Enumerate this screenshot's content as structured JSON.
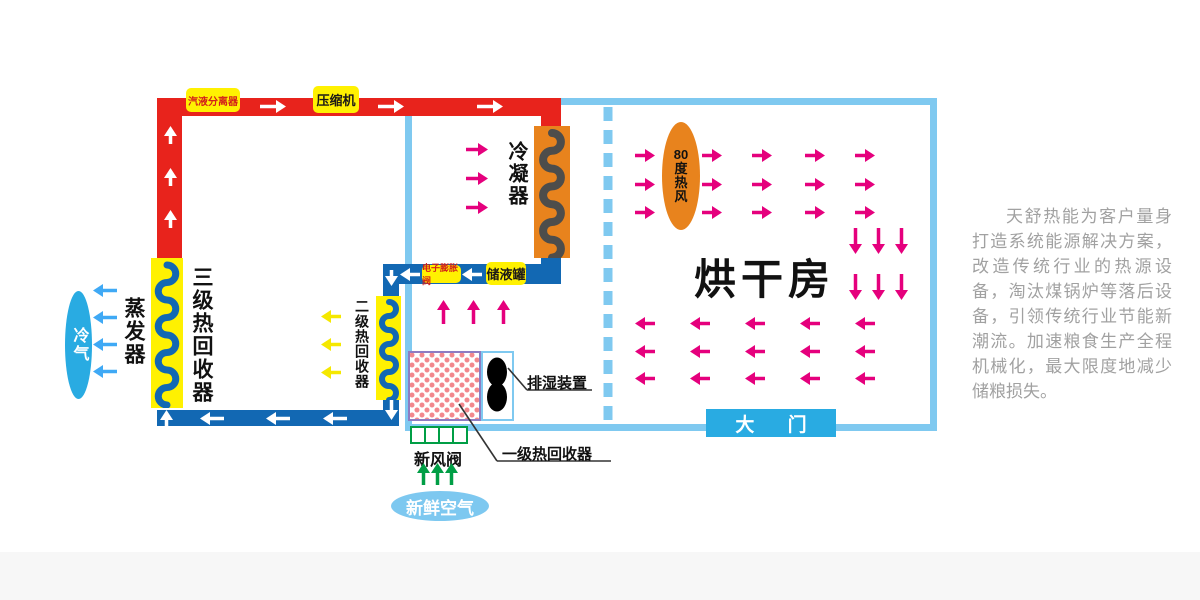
{
  "labels": {
    "gas_liquid_separator": "汽液分离器",
    "compressor": "压缩机",
    "condenser": "冷凝器",
    "expansion_valve": "电子膨胀阀",
    "liquid_tank": "储液罐",
    "stage3_recovery": "三级热回收器",
    "stage2_recovery": "二级热回收器",
    "stage1_recovery": "一级热回收器",
    "evaporator": "蒸发器",
    "cold_air": "冷气",
    "dehumidifier": "排湿装置",
    "fresh_air_valve": "新风阀",
    "fresh_air": "新鲜空气",
    "hot_air_80": "80度热风",
    "drying_room": "烘干房",
    "door": "大 门"
  },
  "description": "天舒热能为客户量身打造系统能源解决方案，改造传统行业的热源设备，淘汰煤锅炉等落后设备，引领传统行业节能新潮流。加速粮食生产全程机械化，最大限度地减少储粮损失。",
  "colors": {
    "pipe_hot": "#e8231c",
    "pipe_cold": "#1268b3",
    "wall": "#7fc9f0",
    "label_bg": "#fff101",
    "condenser": "#e8831d",
    "coil_dark": "#4d4d4b",
    "flow_pink": "#e5007d",
    "flow_blue": "#3fa9f5",
    "flow_green": "#009e45",
    "flow_yellow": "#f5e800",
    "oval_blue": "#29abe2",
    "oval_light": "#7dc8f0",
    "text_gray": "#a1a1a1",
    "door": "#29abe2"
  },
  "flows": [
    {
      "name": "refrigerant-up-arrows",
      "dir": "up",
      "len": 18,
      "color": "#ffffff",
      "points": [
        [
          164,
          126
        ],
        [
          164,
          168
        ],
        [
          164,
          210
        ]
      ]
    },
    {
      "name": "refrigerant-right-arrows",
      "dir": "right",
      "len": 26,
      "color": "#ffffff",
      "points": [
        [
          260,
          100
        ],
        [
          378,
          100
        ],
        [
          477,
          100
        ]
      ]
    },
    {
      "name": "condenser-heat-arrows",
      "dir": "right",
      "len": 22,
      "color": "#e5007d",
      "points": [
        [
          466,
          143
        ],
        [
          466,
          172
        ],
        [
          466,
          201
        ]
      ]
    },
    {
      "name": "liquid-line-left-arrows",
      "dir": "left",
      "len": 20,
      "color": "#ffffff",
      "points": [
        [
          400,
          268
        ],
        [
          462,
          268
        ]
      ]
    },
    {
      "name": "stage2-down-arrow",
      "dir": "down",
      "len": 20,
      "color": "#ffffff",
      "points": [
        [
          385,
          400
        ]
      ]
    },
    {
      "name": "liquid-line-down-arrow",
      "dir": "down",
      "len": 16,
      "color": "#ffffff",
      "points": [
        [
          385,
          270
        ]
      ]
    },
    {
      "name": "stage2-heat-arrows",
      "dir": "left",
      "len": 20,
      "color": "#f5e800",
      "points": [
        [
          321,
          310
        ],
        [
          321,
          338
        ],
        [
          321,
          366
        ]
      ]
    },
    {
      "name": "suction-line-left-arrows",
      "dir": "left",
      "len": 24,
      "color": "#ffffff",
      "points": [
        [
          200,
          412
        ],
        [
          266,
          412
        ],
        [
          323,
          412
        ]
      ]
    },
    {
      "name": "suction-line-up-arrow",
      "dir": "up",
      "len": 16,
      "color": "#ffffff",
      "points": [
        [
          160,
          410
        ]
      ]
    },
    {
      "name": "cold-air-arrows",
      "dir": "left",
      "len": 24,
      "color": "#3fa9f5",
      "points": [
        [
          93,
          284
        ],
        [
          93,
          311
        ],
        [
          93,
          338
        ],
        [
          93,
          365
        ]
      ]
    },
    {
      "name": "recovered-air-up-arrows",
      "dir": "up",
      "len": 24,
      "color": "#e5007d",
      "points": [
        [
          437,
          300
        ],
        [
          467,
          300
        ],
        [
          497,
          300
        ]
      ]
    },
    {
      "name": "fresh-air-up-arrows",
      "dir": "up",
      "len": 22,
      "color": "#009e45",
      "points": [
        [
          417,
          463
        ],
        [
          431,
          463
        ],
        [
          445,
          463
        ]
      ]
    },
    {
      "name": "hot-air-right-arrows",
      "dir": "right",
      "len": 20,
      "color": "#e5007d",
      "points": [
        [
          635,
          149
        ],
        [
          702,
          149
        ],
        [
          752,
          149
        ],
        [
          805,
          149
        ],
        [
          855,
          149
        ],
        [
          635,
          178
        ],
        [
          702,
          178
        ],
        [
          752,
          178
        ],
        [
          805,
          178
        ],
        [
          855,
          178
        ],
        [
          635,
          206
        ],
        [
          702,
          206
        ],
        [
          752,
          206
        ],
        [
          805,
          206
        ],
        [
          855,
          206
        ]
      ]
    },
    {
      "name": "hot-air-down-arrows",
      "dir": "down",
      "len": 26,
      "color": "#e5007d",
      "points": [
        [
          849,
          228
        ],
        [
          872,
          228
        ],
        [
          895,
          228
        ],
        [
          849,
          274
        ],
        [
          872,
          274
        ],
        [
          895,
          274
        ]
      ]
    },
    {
      "name": "return-air-left-arrows",
      "dir": "left",
      "len": 20,
      "color": "#e5007d",
      "points": [
        [
          635,
          317
        ],
        [
          690,
          317
        ],
        [
          745,
          317
        ],
        [
          800,
          317
        ],
        [
          855,
          317
        ],
        [
          635,
          345
        ],
        [
          690,
          345
        ],
        [
          745,
          345
        ],
        [
          800,
          345
        ],
        [
          855,
          345
        ],
        [
          635,
          372
        ],
        [
          690,
          372
        ],
        [
          745,
          372
        ],
        [
          800,
          372
        ],
        [
          855,
          372
        ]
      ]
    }
  ]
}
